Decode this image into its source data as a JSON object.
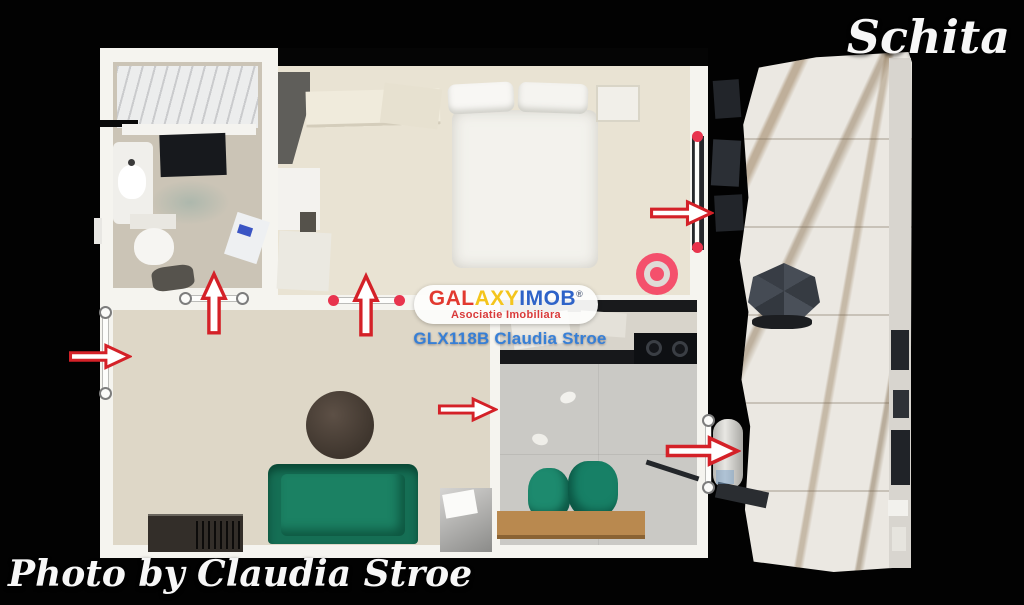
{
  "header": {
    "title": "Schita"
  },
  "footer": {
    "photo_credit": "Photo by Claudia Stroe"
  },
  "watermark": {
    "brand": {
      "segment_red": "GAL",
      "segment_yellow": "AXY",
      "segment_blue": "IMOB",
      "registered": "®"
    },
    "subtitle": "Asociatie Imobiliara",
    "listing_code": "GLX118B Claudia Stroe"
  },
  "icons": {
    "navigation_up_arrows": [
      "arrow-up-icon",
      "arrow-up-icon"
    ],
    "navigation_right_arrows": [
      "arrow-right-icon",
      "arrow-right-icon",
      "arrow-right-icon",
      "arrow-right-icon"
    ],
    "position_marker": "bullseye-icon",
    "measurement_endpoints": [
      "circle-handle-icon",
      "red-dot-icon"
    ]
  },
  "colors": {
    "background": "#020202",
    "wall_white": "#f5f4ef",
    "arrow_stroke": "#d42128",
    "arrow_fill": "#ffffff",
    "bullseye_pink": "#f4506c",
    "marker_red": "#e8344e",
    "brand_red": "#e23a30",
    "brand_yellow": "#f4c51c",
    "brand_blue": "#2e63c8",
    "subtitle_red": "#d93a3a",
    "listing_code_blue": "#2f7cd8",
    "sofa_green": "#156e54",
    "caption_white": "#f7f7f7"
  }
}
